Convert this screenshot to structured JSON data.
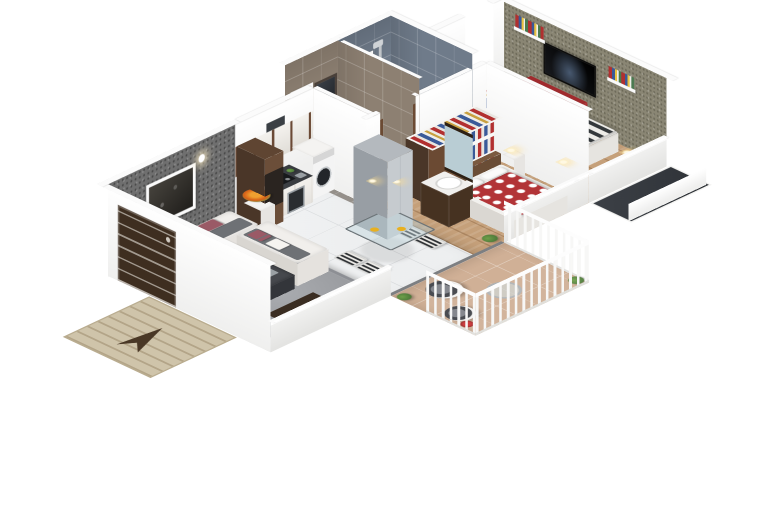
{
  "scene": {
    "description": "3D isometric cutaway floor plan render of an apartment",
    "background": "#ffffff"
  },
  "rooms": [
    {
      "name": "living-room"
    },
    {
      "name": "entrance"
    },
    {
      "name": "kitchen"
    },
    {
      "name": "dining-area"
    },
    {
      "name": "utility"
    },
    {
      "name": "hallway"
    },
    {
      "name": "bathroom"
    },
    {
      "name": "shower-room"
    },
    {
      "name": "kids-bedroom"
    },
    {
      "name": "master-bedroom"
    },
    {
      "name": "balcony"
    }
  ],
  "palette": {
    "tile": "#f0f1f2",
    "grout": "#d8dadc",
    "wood": "#c5a07a",
    "bathA_floor": "#95908a",
    "bathB_floor": "#7f8b99",
    "balcony": "#d0b096",
    "gray_wall": "#6f6f6f",
    "olive_wall": "#8a8674",
    "bathA_wall": "#8d8072",
    "bathB_wall": "#6f7b8a",
    "white_wall": "#efefee",
    "door_brown": "#3e2e20",
    "cabinet_brown": "#5f4532",
    "counter_dark": "#3a3d41",
    "sofa_frame": "#f1efec",
    "sofa_seat": "#6e7175",
    "cushion": "#9a5a66",
    "rug": "#9b9da1",
    "red_duvet": "#b23437",
    "stripe_dark": "#34383b",
    "red_cabinet": "#a02a2d",
    "mirror": "#b9cdd4",
    "railing": "#f7f7f6",
    "duct": "#2e3237",
    "mat": "#cfc4aa",
    "arrow": "#4a3826",
    "plant": "#4e7a3a",
    "toilet": "#fafafa",
    "bed_white": "#f2f1ee",
    "pillow": "#fbfbfa",
    "headboard2": "#7a5a40",
    "wardrobe_brown": "#6b4a33"
  }
}
